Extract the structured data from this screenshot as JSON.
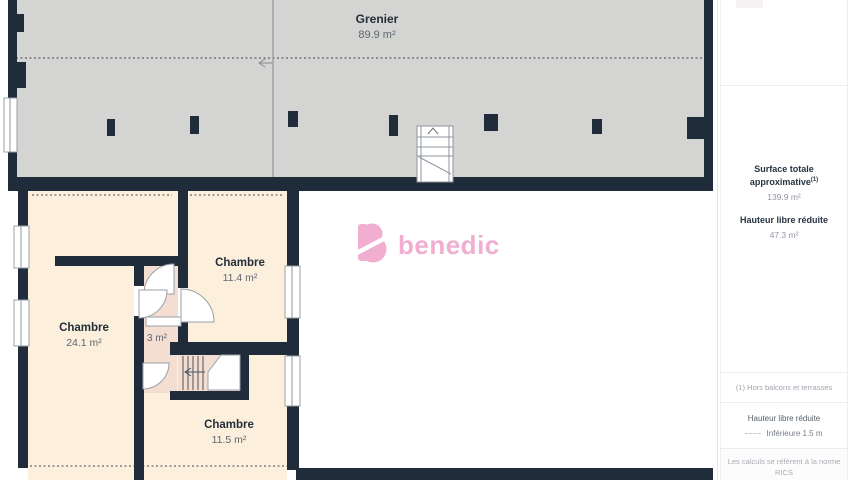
{
  "plan": {
    "attic_label": {
      "name": "Grenier",
      "area": "89.9 m²"
    },
    "rooms": [
      {
        "name": "Chambre",
        "area": "24.1 m²"
      },
      {
        "name": "Chambre",
        "area": "11.4 m²"
      },
      {
        "name": "Chambre",
        "area": "11.5 m²"
      }
    ],
    "small_room_area": "3 m²"
  },
  "logo": {
    "text": "benedic"
  },
  "sidebar": {
    "surface_label": "Surface totale approximative",
    "surface_sup": "(1)",
    "surface_value": "139.9 m²",
    "hauteur_label": "Hauteur libre réduite",
    "hauteur_value": "47.3 m²",
    "footnote": "(1) Hors balcons et terrasses",
    "legend_title": "Hauteur libre réduite",
    "legend_item": "Inférieure 1.5 m",
    "disclaimer_line1": "Les calculs se réfèrent à la norme RICS",
    "disclaimer_line2": "IPMS 3C. Toutes les mesures sont"
  },
  "icons": {
    "attic_ladder": "ladder",
    "stairs_direction": "arrow-left",
    "section_marker": "arrow-left"
  },
  "colors": {
    "wall": "#202c39",
    "attic": "#d4d4d3",
    "room": "#fcf0dc",
    "circ": "#f4ded2",
    "brand": "#f1aed1",
    "textdark": "#232e3a",
    "textgray": "#5c6670"
  }
}
